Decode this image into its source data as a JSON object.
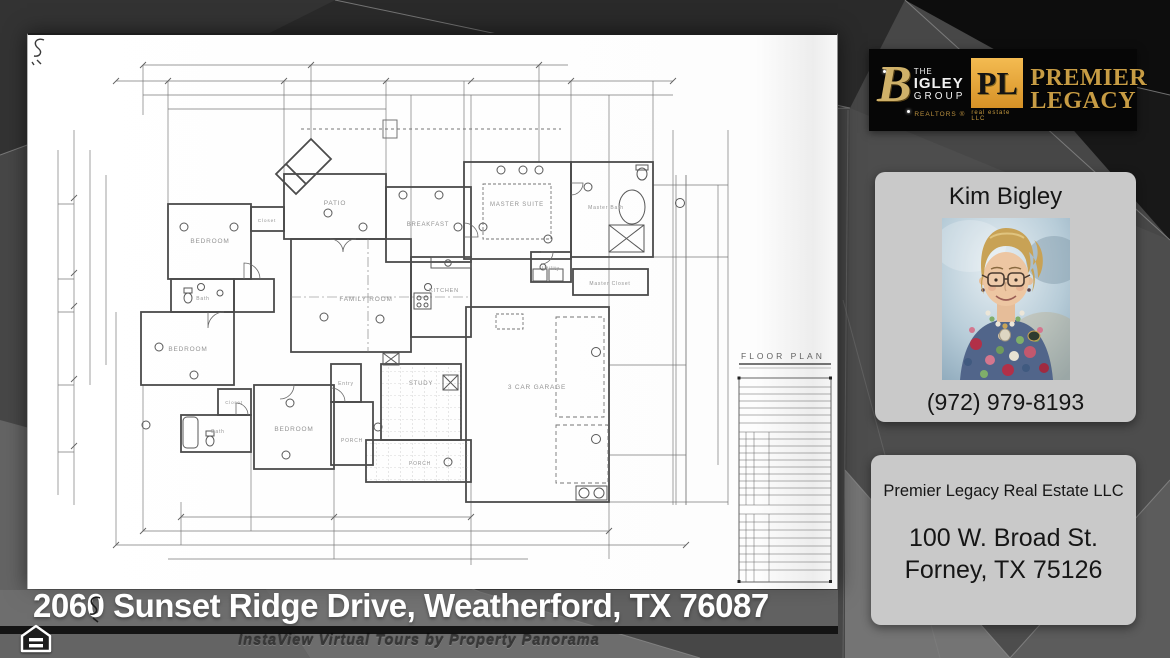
{
  "address_bar": {
    "text": "2060 Sunset Ridge Drive, Weatherford, TX 76087"
  },
  "footer": {
    "watermark": "InstaView Virtual Tours by Property Panorama"
  },
  "logo": {
    "bigley": {
      "b": "B",
      "the": "THE",
      "igley": "IGLEY",
      "group": "GROUP",
      "realtors": "REALTORS ®"
    },
    "premier": {
      "monogram": "PL",
      "sub": "real estate LLC",
      "line1": "PREMIER",
      "line2": "LEGACY"
    },
    "colors": {
      "gold": "#c79c44",
      "banner_black": "#060606"
    }
  },
  "agent": {
    "name": "Kim Bigley",
    "phone": "(972) 979-8193"
  },
  "office": {
    "company": "Premier Legacy Real Estate LLC",
    "line1": "100 W. Broad St.",
    "line2": "Forney, TX 75126"
  },
  "plan": {
    "title": "FLOOR PLAN",
    "labels": [
      {
        "text": "BEDROOM"
      },
      {
        "text": "Closet"
      },
      {
        "text": "Bath"
      },
      {
        "text": "BEDROOM"
      },
      {
        "text": "PATIO"
      },
      {
        "text": "BREAKFAST"
      },
      {
        "text": "FAMILY ROOM"
      },
      {
        "text": "KITCHEN"
      },
      {
        "text": "MASTER SUITE"
      },
      {
        "text": "Master Bath"
      },
      {
        "text": "Utility"
      },
      {
        "text": "Master Closet"
      },
      {
        "text": "Bath"
      },
      {
        "text": "Closet"
      },
      {
        "text": "BEDROOM"
      },
      {
        "text": "Entry"
      },
      {
        "text": "STUDY"
      },
      {
        "text": "PORCH"
      },
      {
        "text": "PORCH"
      },
      {
        "text": "3 CAR GARAGE"
      }
    ]
  }
}
